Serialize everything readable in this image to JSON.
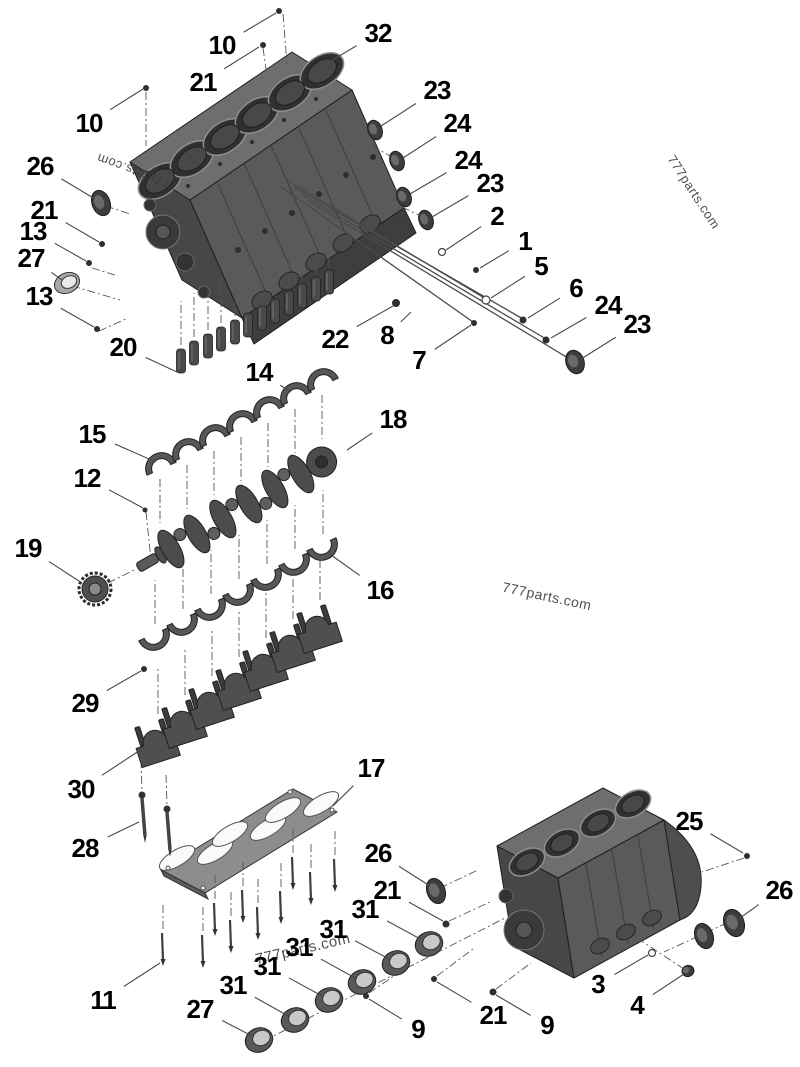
{
  "page": {
    "title": "Engine cylinder block exploded parts diagram"
  },
  "colors": {
    "background": "#ffffff",
    "leader": "#4a4a4a",
    "label": "#000000",
    "metal": "#565656",
    "watermark": "#3c3c3c"
  },
  "watermarks": [
    {
      "text": "777parts.com",
      "x": 137,
      "y": 172,
      "rotate": 200,
      "size": 13
    },
    {
      "text": "777parts.com",
      "x": 694,
      "y": 192,
      "rotate": 57,
      "size": 13
    },
    {
      "text": "777parts.com",
      "x": 547,
      "y": 596,
      "rotate": 12,
      "size": 14
    },
    {
      "text": "777parts.com",
      "x": 303,
      "y": 949,
      "rotate": -13,
      "size": 15
    }
  ],
  "callouts": [
    {
      "label": "10",
      "x": 222,
      "y": 45,
      "tx": 276,
      "ty": 13
    },
    {
      "label": "21",
      "x": 203,
      "y": 82,
      "tx": 259,
      "ty": 47
    },
    {
      "label": "32",
      "x": 378,
      "y": 33,
      "tx": 329,
      "ty": 62
    },
    {
      "label": "10",
      "x": 89,
      "y": 123,
      "tx": 143,
      "ty": 89
    },
    {
      "label": "23",
      "x": 437,
      "y": 90,
      "tx": 381,
      "ty": 126
    },
    {
      "label": "24",
      "x": 457,
      "y": 123,
      "tx": 403,
      "ty": 158
    },
    {
      "label": "24",
      "x": 468,
      "y": 160,
      "tx": 410,
      "ty": 194
    },
    {
      "label": "23",
      "x": 490,
      "y": 183,
      "tx": 432,
      "ty": 217
    },
    {
      "label": "2",
      "x": 497,
      "y": 216,
      "tx": 446,
      "ty": 250
    },
    {
      "label": "1",
      "x": 525,
      "y": 241,
      "tx": 480,
      "ty": 268
    },
    {
      "label": "5",
      "x": 541,
      "y": 266,
      "tx": 491,
      "ty": 298
    },
    {
      "label": "6",
      "x": 576,
      "y": 288,
      "tx": 528,
      "ty": 318
    },
    {
      "label": "24",
      "x": 608,
      "y": 305,
      "tx": 551,
      "ty": 338
    },
    {
      "label": "23",
      "x": 637,
      "y": 324,
      "tx": 581,
      "ty": 359
    },
    {
      "label": "26",
      "x": 40,
      "y": 166,
      "tx": 95,
      "ty": 199
    },
    {
      "label": "21",
      "x": 44,
      "y": 210,
      "tx": 99,
      "ty": 242
    },
    {
      "label": "13",
      "x": 33,
      "y": 231,
      "tx": 86,
      "ty": 261
    },
    {
      "label": "27",
      "x": 31,
      "y": 258,
      "tx": 62,
      "ty": 280
    },
    {
      "label": "13",
      "x": 39,
      "y": 296,
      "tx": 94,
      "ty": 327
    },
    {
      "label": "20",
      "x": 123,
      "y": 347,
      "tx": 177,
      "ty": 372
    },
    {
      "label": "22",
      "x": 335,
      "y": 339,
      "tx": 393,
      "ty": 306
    },
    {
      "label": "8",
      "x": 387,
      "y": 335,
      "tx": 411,
      "ty": 312
    },
    {
      "label": "7",
      "x": 419,
      "y": 360,
      "tx": 471,
      "ty": 325
    },
    {
      "label": "14",
      "x": 259,
      "y": 372,
      "tx": 291,
      "ty": 392
    },
    {
      "label": "15",
      "x": 92,
      "y": 434,
      "tx": 156,
      "ty": 462
    },
    {
      "label": "12",
      "x": 87,
      "y": 478,
      "tx": 143,
      "ty": 508
    },
    {
      "label": "19",
      "x": 28,
      "y": 548,
      "tx": 82,
      "ty": 583
    },
    {
      "label": "18",
      "x": 393,
      "y": 419,
      "tx": 347,
      "ty": 450
    },
    {
      "label": "16",
      "x": 380,
      "y": 590,
      "tx": 327,
      "ty": 552
    },
    {
      "label": "29",
      "x": 85,
      "y": 703,
      "tx": 141,
      "ty": 671
    },
    {
      "label": "30",
      "x": 81,
      "y": 789,
      "tx": 148,
      "ty": 745
    },
    {
      "label": "28",
      "x": 85,
      "y": 848,
      "tx": 139,
      "ty": 822
    },
    {
      "label": "17",
      "x": 371,
      "y": 768,
      "tx": 333,
      "ty": 806
    },
    {
      "label": "11",
      "x": 103,
      "y": 1000,
      "tx": 160,
      "ty": 963
    },
    {
      "label": "27",
      "x": 200,
      "y": 1009,
      "tx": 254,
      "ty": 1037
    },
    {
      "label": "31",
      "x": 233,
      "y": 985,
      "tx": 290,
      "ty": 1017
    },
    {
      "label": "31",
      "x": 267,
      "y": 966,
      "tx": 324,
      "ty": 997
    },
    {
      "label": "31",
      "x": 299,
      "y": 947,
      "tx": 357,
      "ty": 979
    },
    {
      "label": "31",
      "x": 333,
      "y": 929,
      "tx": 391,
      "ty": 960
    },
    {
      "label": "31",
      "x": 365,
      "y": 909,
      "tx": 424,
      "ty": 941
    },
    {
      "label": "26",
      "x": 378,
      "y": 853,
      "tx": 430,
      "ty": 886
    },
    {
      "label": "21",
      "x": 387,
      "y": 890,
      "tx": 443,
      "ty": 921
    },
    {
      "label": "9",
      "x": 418,
      "y": 1029,
      "tx": 369,
      "ty": 999
    },
    {
      "label": "21",
      "x": 493,
      "y": 1015,
      "tx": 437,
      "ty": 982
    },
    {
      "label": "9",
      "x": 547,
      "y": 1025,
      "tx": 496,
      "ty": 995
    },
    {
      "label": "3",
      "x": 598,
      "y": 984,
      "tx": 648,
      "ty": 955
    },
    {
      "label": "4",
      "x": 637,
      "y": 1005,
      "tx": 684,
      "ty": 974
    },
    {
      "label": "25",
      "x": 689,
      "y": 821,
      "tx": 743,
      "ty": 853
    },
    {
      "label": "26",
      "x": 779,
      "y": 890,
      "tx": 740,
      "ty": 918
    }
  ]
}
